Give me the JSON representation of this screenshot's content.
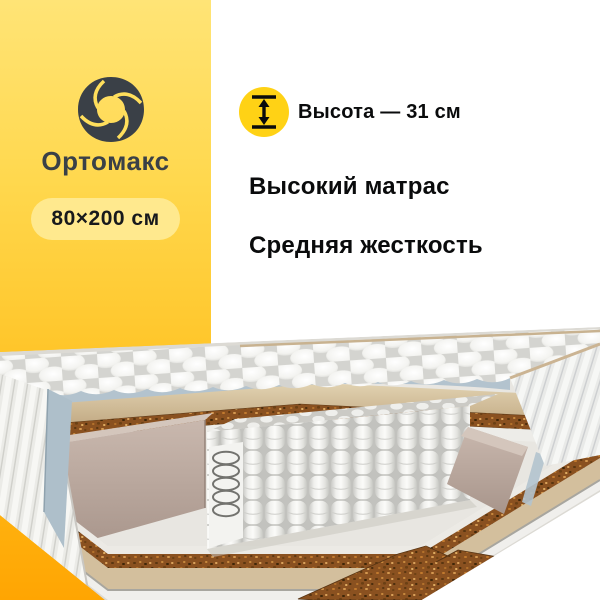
{
  "panel": {
    "brand_name": "Ортомакс",
    "size_badge_label": "80×200 см",
    "bg_gradient_top": "#FFE476",
    "bg_gradient_bottom": "#FFA502",
    "badge_bg": "#FFE98E",
    "brand_color": "#3A4047"
  },
  "info": {
    "height_label": "Высота — 31 см",
    "feature_1": "Высокий матрас",
    "feature_2": "Средняя жесткость",
    "height_icon": "height-measure-arrow-icon",
    "height_icon_bg": "#FFD215",
    "text_color": "#0A0B0C"
  },
  "illustration": {
    "subject": "mattress-3d-cutaway",
    "elements": [
      "quilted-top-cover",
      "knit-underside-layer",
      "foam-comfort-layer",
      "coconut-coir-layer",
      "felt-layer",
      "pocket-spring-block",
      "exposed-steel-spring",
      "foam-side-frame",
      "quilted-side-cover",
      "bottom-layer-stack",
      "coir-step-piece"
    ],
    "palette": {
      "quilt_white": "#F4F4F2",
      "knit_blue": "#B3C3CE",
      "foam_beige": "#D8C5A3",
      "coir_brown": "#8A5120",
      "felt_white": "#ECEBE7",
      "frame_taupe": "#BFACA2",
      "spring_white": "#EDEDEA"
    }
  }
}
